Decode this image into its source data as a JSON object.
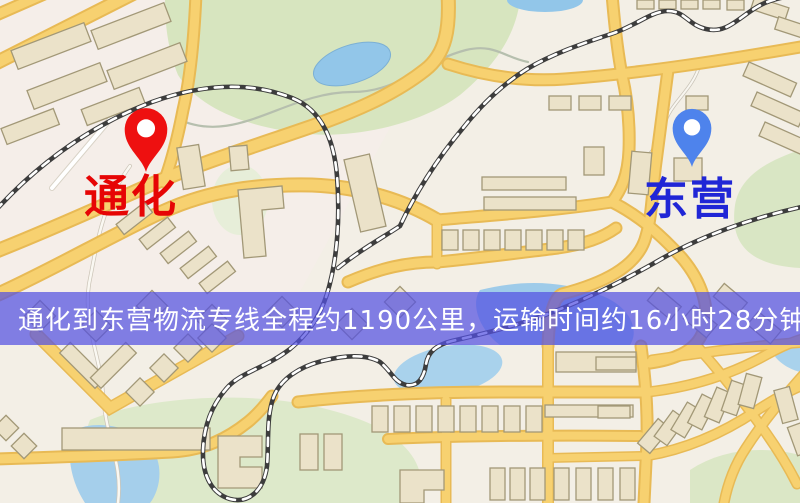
{
  "map": {
    "markers": [
      {
        "id": "origin",
        "label": "通化",
        "pin_icon": "map-pin",
        "pin_color": "#ee1010",
        "label_color": "#e60505"
      },
      {
        "id": "destination",
        "label": "东营",
        "pin_icon": "map-pin",
        "pin_color": "#4e83ec",
        "label_color": "#2026d6"
      }
    ],
    "banner": {
      "text": "通化到东营物流专线全程约1190公里，运输时间约16小时28分钟.",
      "background": "rgba(83,81,226,0.72)",
      "text_color": "#ffffff"
    },
    "theme": {
      "base": "#f3efe6",
      "road_fill": "#f7d170",
      "road_casing": "#e8ba55",
      "park_green": "#d7e5bf",
      "water_blue": "#99c8ea",
      "building_fill": "#ebe2c9",
      "building_outline": "#a29877",
      "railway_dark": "#3d3d3d"
    }
  }
}
